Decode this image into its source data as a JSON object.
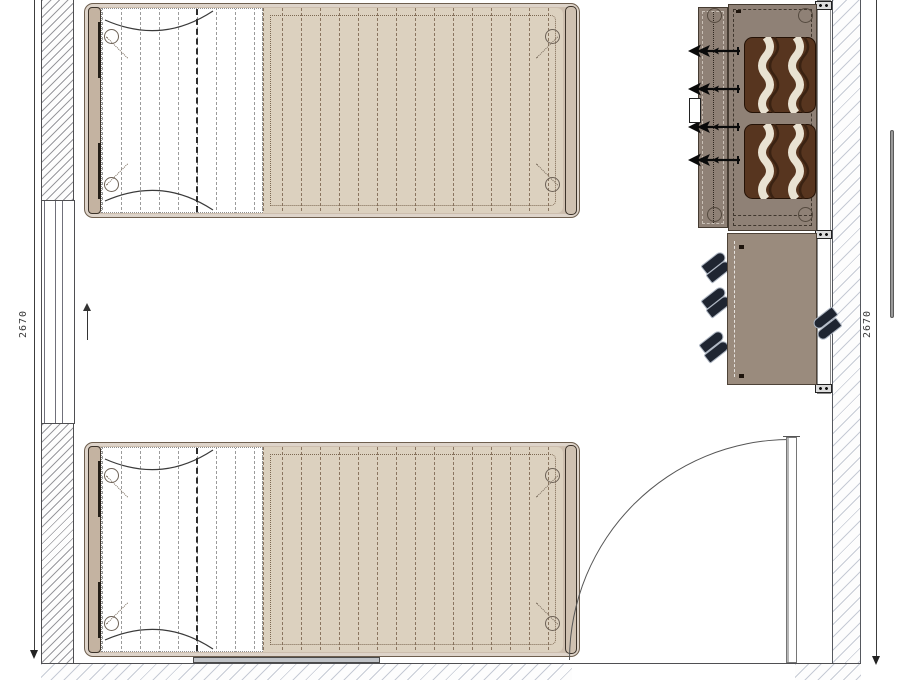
{
  "document": {
    "type": "architectural floor plan",
    "view": "top-down bedroom layout"
  },
  "dimension_labels": [
    {
      "side": "left",
      "text": "2670"
    },
    {
      "side": "right",
      "text": "2670"
    }
  ],
  "room": {
    "walls": [
      "left",
      "right",
      "bottom"
    ],
    "window": {
      "wall": "left"
    },
    "door": {
      "wall": "bottom",
      "swing": "quarter-arc into room",
      "hinge_side": "right"
    }
  },
  "furniture": {
    "beds": [
      {
        "id": "bed-top",
        "type": "single bed",
        "buttons": 4
      },
      {
        "id": "bed-bottom",
        "type": "single bed",
        "buttons": 4
      }
    ],
    "wardrobe": {
      "hangers": 4,
      "folded_blankets": 2,
      "wall_brackets": 3
    },
    "shoe_cabinet": {
      "shoe_groups_left": 3,
      "shoe_groups_right": 1
    }
  },
  "palette": {
    "wall_hatch_dense": "#78787e",
    "wall_hatch_light": "#a8b0c0",
    "bed_frame": "#cdbeae",
    "bed_frame_border": "#6e5f4f",
    "duvet": "#dcd1bf",
    "sheet": "#ffffff",
    "stitch": "#8a7560",
    "wardrobe_body": "#8f8176",
    "cabinet_body": "#9a8b7d",
    "blanket_brown": "#57351f",
    "blanket_cream": "#e9e2d2",
    "shoe": "#1f2531",
    "underbed_bar": "#c0c3c7",
    "line": "#4f4f52"
  }
}
